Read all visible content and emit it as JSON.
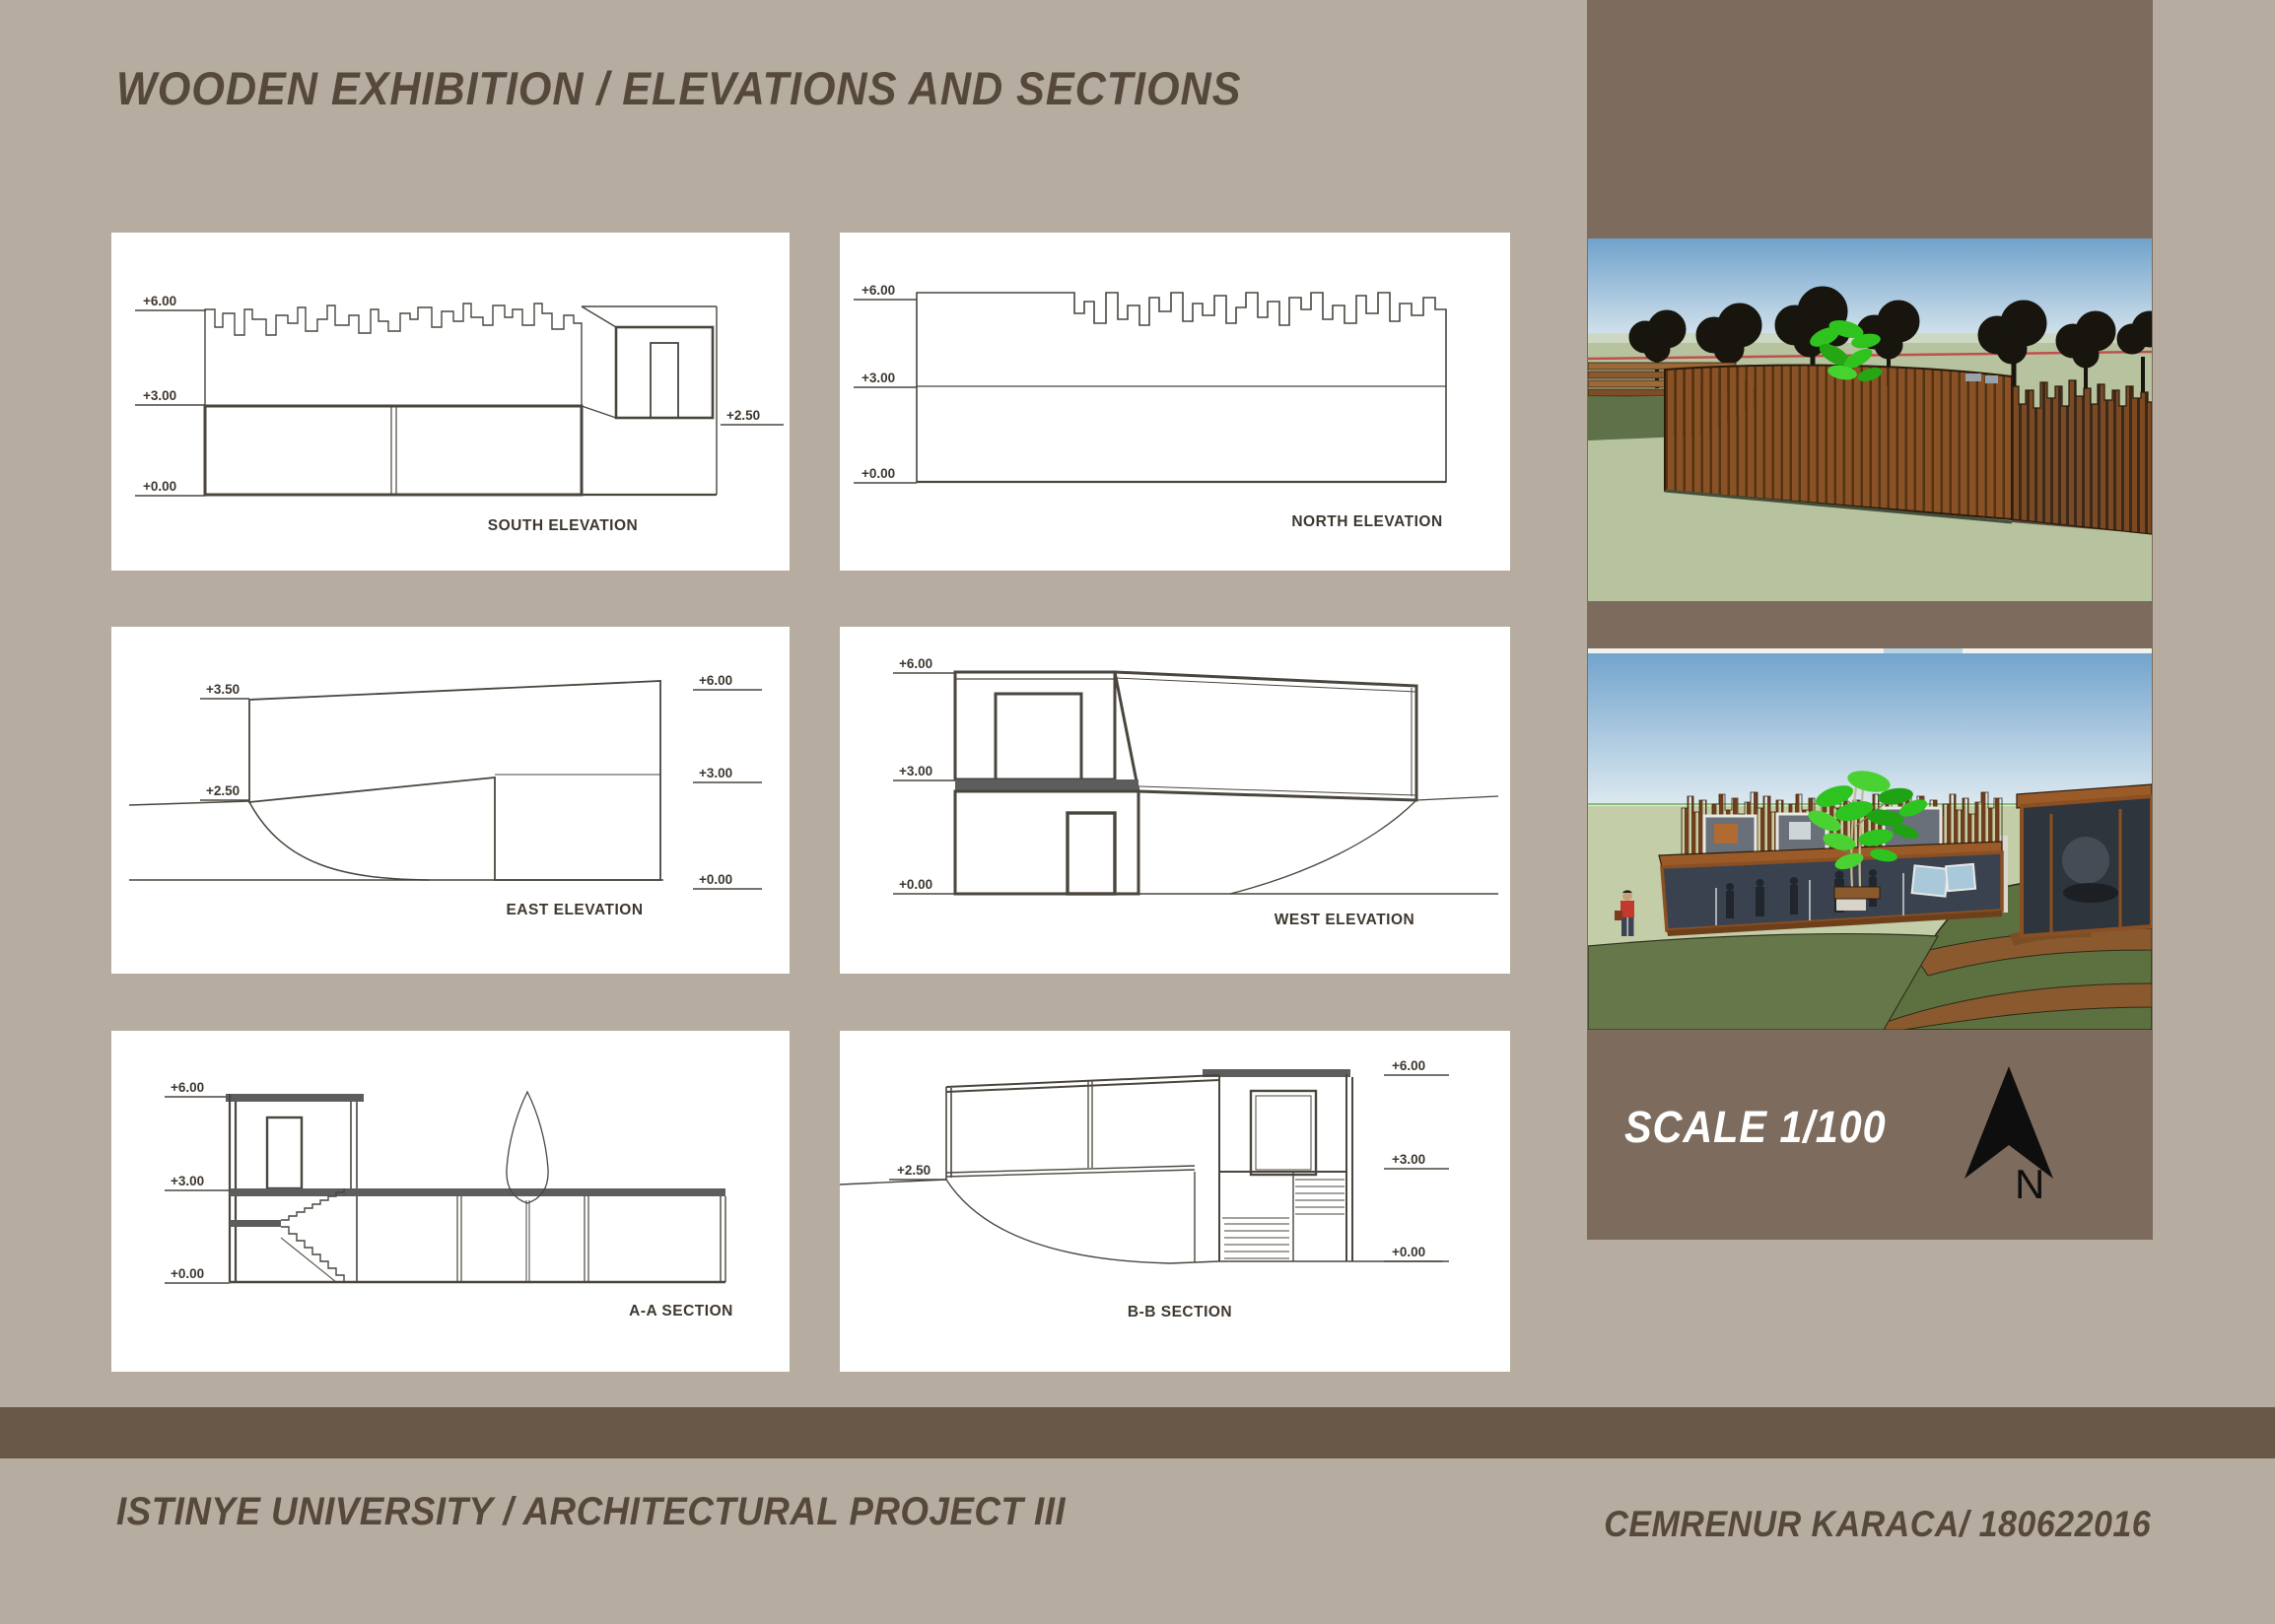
{
  "header": {
    "title": "WOODEN EXHIBITION / ELEVATIONS AND SECTIONS"
  },
  "panels": {
    "south": {
      "caption": "SOUTH ELEVATION",
      "levels": [
        "+6.00",
        "+3.00",
        "+0.00",
        "+2.50"
      ]
    },
    "north": {
      "caption": "NORTH ELEVATION",
      "levels": [
        "+6.00",
        "+3.00",
        "+0.00"
      ]
    },
    "east": {
      "caption": "EAST ELEVATION",
      "levels": [
        "+3.50",
        "+2.50",
        "+6.00",
        "+3.00",
        "+0.00"
      ]
    },
    "west": {
      "caption": "WEST ELEVATION",
      "levels": [
        "+6.00",
        "+3.00",
        "+0.00"
      ]
    },
    "aa": {
      "caption": "A-A SECTION",
      "levels": [
        "+6.00",
        "+3.00",
        "+0.00"
      ]
    },
    "bb": {
      "caption": "B-B SECTION",
      "levels": [
        "+2.50",
        "+6.00",
        "+3.00",
        "+0.00"
      ]
    }
  },
  "sidebar": {
    "scale_label": "SCALE 1/100",
    "north_label": "N"
  },
  "footer": {
    "left": "ISTINYE UNIVERSITY / ARCHITECTURAL PROJECT III",
    "right": "CEMRENUR KARACA/ 180622016"
  },
  "colors": {
    "background": "#b6aca0",
    "sidebar": "#7d6c5e",
    "footer_bar": "#695848",
    "text_brown": "#57483c",
    "panel_bg": "#ffffff",
    "drawing_line": "#4a463e",
    "scale_text": "#ffffff",
    "render_sky": "#76a5cb",
    "render_grass": "#b6c39e",
    "wood": "#8a5126",
    "red_guideline": "#c0504d",
    "bright_green": "#2ec41f"
  }
}
